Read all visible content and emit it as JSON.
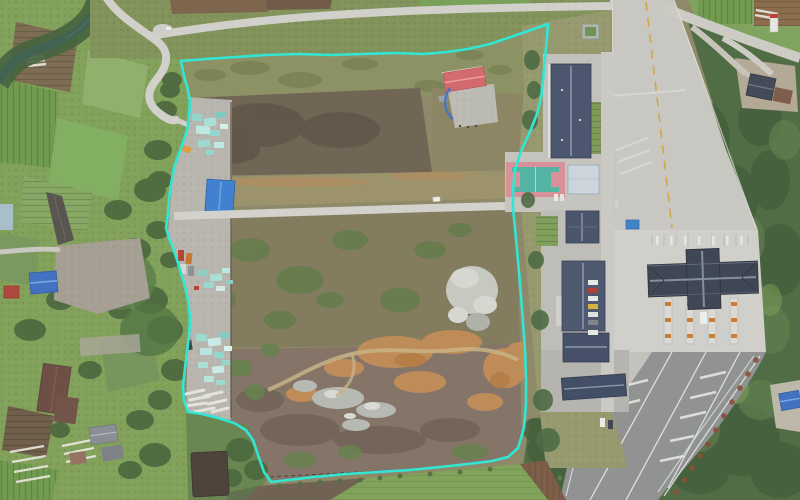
{
  "image": {
    "width": 800,
    "height": 500,
    "type": "aerial-drone-photo"
  },
  "scene": {
    "description": "Drone orthophoto of a large cleared land parcel outlined with a bright cyan boundary polygon; farmland, a tree-lined river and village houses lie to the west, a winding rural road to the north, and an expressway toll station with slate-roofed buildings to the east."
  },
  "overlay": {
    "boundary_color": "#2BE8D6",
    "boundary_stroke_width": "2.6",
    "boundary_points": "181,61 206,59 236,57 266,55 298,54 330,55 362,54 396,53 424,54 447,52 468,49 490,44 511,37 531,30 548,24 547,38 545,58 543,80 541,98 537,114 529,134 521,151 515,170 513,190 513,208 515,228 517,250 519,272 521,296 523,322 525,350 526,378 526,404 524,428 518,448 508,457 492,461 468,464 440,467 410,470 378,472 346,474 314,477 288,480 271,482 264,472 258,455 253,440 246,430 234,423 218,418 202,414 188,412 184,400 183,386 185,368 187,352 189,336 190,318 188,300 184,283 179,266 174,251 169,238 166,228 168,214 169,199 171,184 174,168 178,156 183,143 187,130 189,116 190,102 188,90 184,76 181,61"
  },
  "palette": {
    "farmland_green": "#7FA057",
    "forest_green": "#4D6A41",
    "scrub_olive": "#8C8765",
    "scrub_maroon": "#6E6152",
    "scrub_mauve": "#837265",
    "bare_dirt_orange": "#C48C54",
    "rubble_gray": "#C6C9C0",
    "road_concrete": "#D2D1CA",
    "asphalt_gray": "#8E9190",
    "toll_canopy_slate": "#3A4150",
    "building_roof_slate": "#47526B",
    "shed_roof_blue": "#3C7ED0",
    "red_roof": "#D4666B",
    "court_teal": "#4FB3A3",
    "court_pink": "#D98F96",
    "river_green": "#3D5F4E",
    "pond_brown": "#493F37",
    "stockpile_teal": "#8FD8CE",
    "lane_line_yellow": "#D2A842",
    "lane_line_white": "#EDEDE8"
  },
  "features": [
    {
      "id": "site-boundary-overlay",
      "label": "Cyan surveyed parcel boundary"
    },
    {
      "id": "parcel-interior",
      "label": "Cleared scrubland inside the boundary"
    },
    {
      "id": "west-staging-area",
      "label": "Construction staging strip with turquoise stockpiles, sheds, trucks and pipe racks"
    },
    {
      "id": "internal-road",
      "label": "Straight internal access road crossing the parcel"
    },
    {
      "id": "red-roof-building",
      "label": "Red-roofed building with concrete pad inside the parcel"
    },
    {
      "id": "basketball-court",
      "label": "Teal sports court with pink border"
    },
    {
      "id": "campus-buildings",
      "label": "Row of slate-roofed buildings east of the parcel"
    },
    {
      "id": "toll-plaza-canopy",
      "label": "Cross-shaped expressway toll canopy"
    },
    {
      "id": "toll-booths",
      "label": "Toll lane islands and booths"
    },
    {
      "id": "expressway",
      "label": "Expressway: concrete approach north, asphalt carriageway south"
    },
    {
      "id": "country-road",
      "label": "Winding rural road along the north-west"
    },
    {
      "id": "river",
      "label": "Tree-lined river in the north-west corner"
    },
    {
      "id": "west-farmland",
      "label": "Crop fields and greenhouses west of the site"
    },
    {
      "id": "village-houses",
      "label": "Village farm houses"
    },
    {
      "id": "pond",
      "label": "Dark pond at the south-west boundary"
    },
    {
      "id": "south-fields",
      "label": "Crop fields south of the boundary"
    },
    {
      "id": "east-forest",
      "label": "Dense woodland east of the expressway"
    },
    {
      "id": "dirt-patches",
      "label": "Exposed orange earth and grey rubble piles"
    },
    {
      "id": "white-car",
      "label": "White car on the internal road"
    }
  ]
}
